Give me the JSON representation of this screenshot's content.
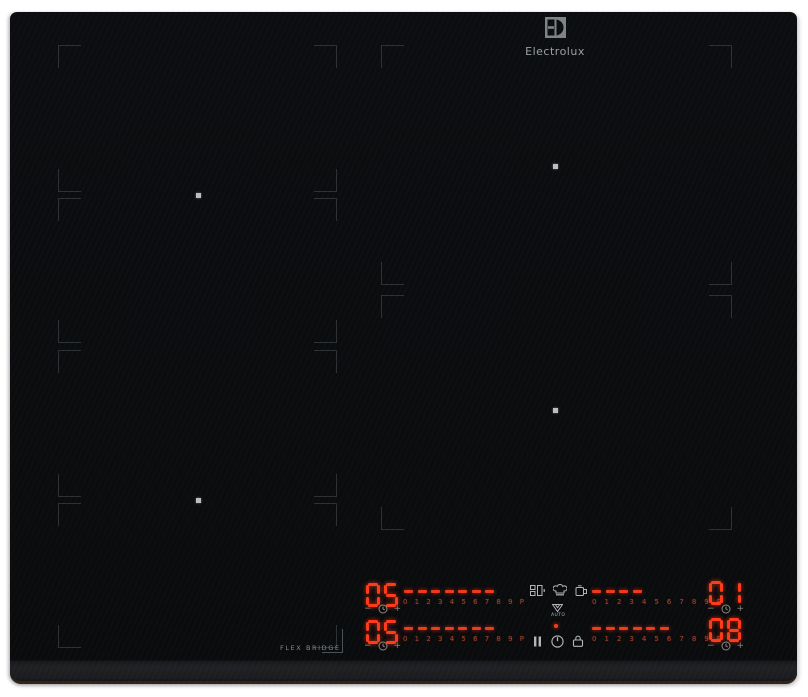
{
  "brand": {
    "logo_text": "Electrolux",
    "logo_mark": "electrolux-emblem"
  },
  "surface": {
    "flex_bridge_label": "FLEX BRIDGE",
    "zones": {
      "left_segments": 4,
      "right_zones": 2,
      "pan_center_dots": 4
    }
  },
  "panel": {
    "scale": "0 1 2 3 4 5 6 7 8 9 P",
    "minus_label": "−",
    "plus_label": "+",
    "auto_label": "AUTO",
    "left_rows": [
      {
        "display": "05",
        "dashes": 7
      },
      {
        "display": "05",
        "dashes": 7
      }
    ],
    "right_rows": [
      {
        "display": "01",
        "dashes": 4
      },
      {
        "display": "08",
        "dashes": 6
      }
    ],
    "icons": [
      "flexibridge-icon",
      "chef-hat-icon",
      "pot-icon",
      "hood-auto-icon",
      "pause-icon",
      "power-icon",
      "lock-icon",
      "timer-icon"
    ]
  },
  "colors": {
    "glass": "#0a0c0f",
    "bevel": "#1e2022",
    "led_red": "#ff3b1a",
    "scale_red": "#a4462e",
    "bracket_gray": "#2c3135",
    "icon_gray": "#b2b6b9",
    "logo_gray": "#9aa0a3",
    "background": "#ffffff"
  }
}
